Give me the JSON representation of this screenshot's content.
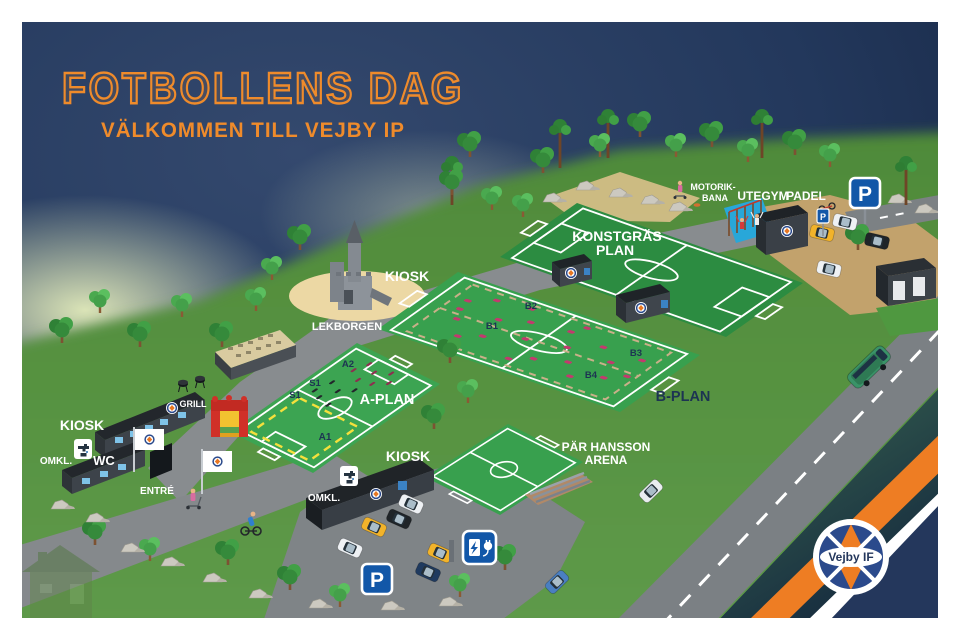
{
  "poster": {
    "title": "FOTBOLLENS DAG",
    "subtitle": "VÄLKOMMEN TILL VEJBY IP"
  },
  "venues": {
    "konstgras_line1": "KONSTGRÄS",
    "konstgras_line2": "PLAN",
    "a_plan": "A-PLAN",
    "b_plan": "B-PLAN",
    "par_hansson_line1": "PÄR HANSSON",
    "par_hansson_line2": "ARENA",
    "motorik_line1": "MOTORIK-",
    "motorik_line2": "BANA",
    "utegym": "UTEGYM",
    "padel": "PADEL",
    "lekborgen": "LEKBORGEN",
    "kiosk_north": "KIOSK",
    "kiosk_west": "KIOSK",
    "kiosk_south": "KIOSK",
    "grill": "GRILL",
    "omkl_west": "OMKL.",
    "omkl_south": "OMKL.",
    "wc": "WC",
    "entre": "ENTRÉ"
  },
  "zones": {
    "a1": "A1",
    "a2": "A2",
    "s1_upper": "S1",
    "s1_lower": "S1",
    "b1": "B1",
    "b2": "B2",
    "b3": "B3",
    "b4": "B4"
  },
  "signs": {
    "parking": "P",
    "ev_charging": "ev-charging-station",
    "water_tap": "water-tap"
  },
  "club": {
    "name": "Vejby IF"
  },
  "colors": {
    "accent_orange": "#ef8b2b",
    "background_navy": "#23385c",
    "stripe_navy": "#24375c",
    "pitch_green": "#38a04e",
    "artificial_turf_green": "#2c8c41",
    "ground_green": "#578e3e",
    "sign_blue": "#1257a8",
    "marker_magenta": "#c23a6e",
    "zone_yellow": "#f5e03c"
  }
}
